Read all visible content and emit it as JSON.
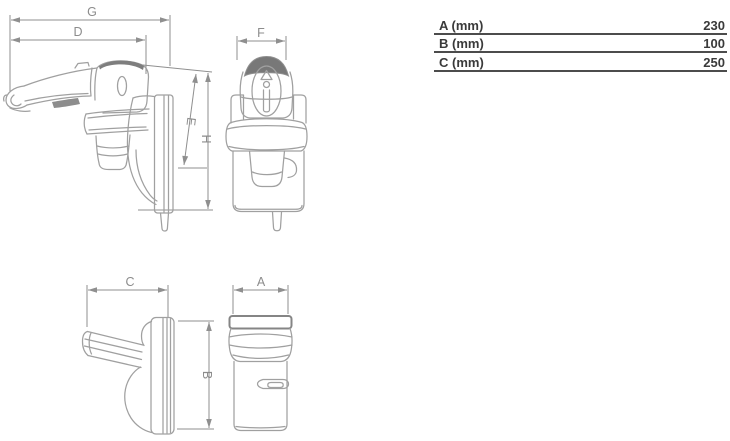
{
  "drawing": {
    "side_view": {
      "dim_g": "G",
      "dim_d": "D",
      "dim_e": "E",
      "dim_h": "H"
    },
    "front_view": {
      "dim_f": "F"
    },
    "top_view": {
      "dim_c": "C",
      "dim_b": "B"
    },
    "bottom_view": {
      "dim_a": "A"
    }
  },
  "spec_table": {
    "rows": [
      {
        "label": "A (mm)",
        "value": "230"
      },
      {
        "label": "B (mm)",
        "value": "100"
      },
      {
        "label": "C (mm)",
        "value": "250"
      }
    ]
  },
  "colors": {
    "drawing_line": "#a0a0a0",
    "dimension_line": "#8f8f8f",
    "dimension_label": "#8c8c8c",
    "shading": "#7a7a7a",
    "table_text": "#3a3a3a",
    "table_rule": "#4c4c4c",
    "background": "#ffffff"
  }
}
